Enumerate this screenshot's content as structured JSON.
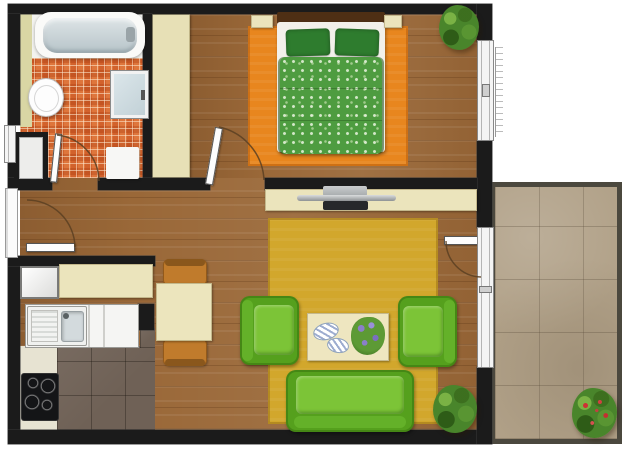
{
  "app": {
    "type": "apartment-floor-plan",
    "view": "top-down",
    "description": "Top-down color floor plan of a one-bedroom apartment with bathroom, kitchen, dining corner, living room and balcony"
  },
  "rooms": [
    {
      "id": "bathroom",
      "label": "Bathroom",
      "floor": "orange-mosaic-tile",
      "items": [
        "bathtub",
        "toilet",
        "shower-cabin",
        "bath-mat",
        "utility-shaft"
      ]
    },
    {
      "id": "bedroom",
      "label": "Bedroom",
      "floor": "wood-plank",
      "items": [
        "double-bed",
        "headboard",
        "pillow-left",
        "pillow-right",
        "green-duvet",
        "nightstand-left",
        "nightstand-right",
        "wardrobe",
        "orange-rug",
        "corner-plant"
      ]
    },
    {
      "id": "hallway",
      "label": "Entry Hall",
      "floor": "wood-plank",
      "items": [
        "entry-door",
        "utility-shaft"
      ]
    },
    {
      "id": "kitchen",
      "label": "Kitchen",
      "floor": "dark-tile",
      "items": [
        "fridge",
        "upper-cabinet",
        "counter",
        "sink-with-drainboard",
        "cooktop"
      ]
    },
    {
      "id": "dining",
      "label": "Dining Corner",
      "floor": "wood-plank",
      "items": [
        "dining-table",
        "chair-top",
        "chair-bottom"
      ]
    },
    {
      "id": "living",
      "label": "Living Room",
      "floor": "wood-plank",
      "items": [
        "tv-console",
        "tv",
        "yellow-rug",
        "armchair-left",
        "armchair-right",
        "coffee-table",
        "decor-plates",
        "flower-bouquet",
        "sofa",
        "floor-plant"
      ]
    },
    {
      "id": "balcony",
      "label": "Balcony",
      "floor": "stone-tile",
      "items": [
        "flowering-plant"
      ]
    }
  ],
  "openings": {
    "doors": [
      "entry-door",
      "bathroom-door",
      "bedroom-door",
      "balcony-door"
    ],
    "windows": [
      "hall-small-window",
      "bedroom-window",
      "balcony-window"
    ]
  },
  "counts": {
    "plants": 3,
    "doors": 4,
    "windows": 3,
    "seats": 5
  },
  "palette": {
    "wall": "#1b1b1b",
    "wood_floor": "#9a6838",
    "bathroom_tile": "#d2622c",
    "kitchen_tile": "#6f6156",
    "balcony_tile": "#b1a188",
    "bedroom_rug": "#e8861e",
    "living_rug": "#d2a72c",
    "upholstery_green": "#6ab52b",
    "duvet_green": "#4e9c40",
    "furniture_cream": "#ebe4bc",
    "chair_brown": "#c07b2c",
    "counter_white": "#f5f5f3"
  }
}
